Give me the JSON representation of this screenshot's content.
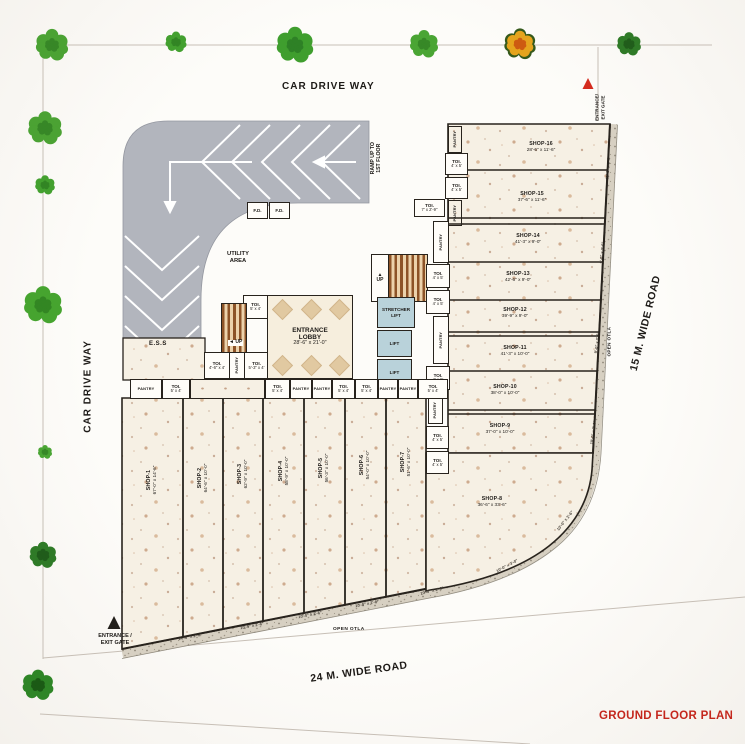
{
  "plan": {
    "title": "GROUND FLOOR PLAN",
    "roads": {
      "top": "CAR DRIVE WAY",
      "left": "CAR DRIVE WAY",
      "right": "15 M. WIDE ROAD",
      "bottom": "24 M. WIDE ROAD"
    },
    "gates": {
      "top_right_line1": "ENTRANCE/",
      "top_right_line2": "EXIT GATE",
      "bottom_left_line1": "ENTRANCE /",
      "bottom_left_line2": "EXIT GATE"
    },
    "ramp": {
      "line1": "RAMP UP TO",
      "line2": "1ST FLOOR",
      "ess": "E.S.S"
    },
    "utility": {
      "line1": "UTILITY",
      "line2": "AREA"
    },
    "lobby": {
      "line1": "ENTRANCE",
      "line2": "LOBBY",
      "dims": "28'-6\" x 21'-0\""
    },
    "stairs": {
      "up": "UP",
      "arrow_up": "▲",
      "arrow_left": "◄"
    },
    "lifts": {
      "stretcher_line1": "STRETCHER",
      "stretcher_line2": "LIFT",
      "lift": "LIFT"
    },
    "fd": "F.D.",
    "open_otla": "OPEN OTLA",
    "pantry": "PANTRY",
    "toilets": {
      "t5x4": {
        "name": "TOI.",
        "dims": "5' x 4'"
      },
      "t4x5": {
        "name": "TOI.",
        "dims": "4' x 5'"
      },
      "t46x4": {
        "name": "TOI.",
        "dims": "4'-6\" x 4'"
      },
      "t53x4": {
        "name": "TOI.",
        "dims": "5'-3\" x 4'"
      },
      "t7x29": {
        "name": "TOI.",
        "dims": "7' x 2'-9\""
      }
    },
    "shops_left": [
      {
        "name": "SHOP-1",
        "dims": "67'-0\" x 14'-6\""
      },
      {
        "name": "SHOP-2",
        "dims": "64'-6\" x 10'-0\""
      },
      {
        "name": "SHOP-3",
        "dims": "62'-9\" x 10'-0\""
      },
      {
        "name": "SHOP-4",
        "dims": "58'-9\" x 10'-0\""
      },
      {
        "name": "SHOP-5",
        "dims": "56'-3\" x 10'-0\""
      },
      {
        "name": "SHOP-6",
        "dims": "54'-0\" x 10'-0\""
      },
      {
        "name": "SHOP-7",
        "dims": "51'-6\" x 10'-0\""
      }
    ],
    "shop8": {
      "name": "SHOP-8",
      "dims": "36'-6\" x 33'-6\""
    },
    "shops_right": [
      {
        "name": "SHOP-16",
        "dims": "28'-6\" x 11'-6\""
      },
      {
        "name": "SHOP-15",
        "dims": "37'-6\" x 11'-6\""
      },
      {
        "name": "SHOP-14",
        "dims": "41'-3\" x 9'-0\""
      },
      {
        "name": "SHOP-13",
        "dims": "42'-6\" x 9'-0\""
      },
      {
        "name": "SHOP-12",
        "dims": "39'-9\" x 9'-0\""
      },
      {
        "name": "SHOP-11",
        "dims": "41'-3\" x 10'-0\""
      },
      {
        "name": "SHOP-10",
        "dims": "38'-0\" x 10'-0\""
      },
      {
        "name": "SHOP-9",
        "dims": "37'-0\" x 10'-0\""
      }
    ],
    "otla_dims": [
      "14'-6\" x 2'-6\"",
      "10'-0\" x 2'-6\"",
      "10'-0\" x 2'-6\"",
      "10'-0\" x 2'-6\"",
      "10'-0\" x 2'-6\"",
      "10'-0\" x 3'-0\"",
      "10'-0\" x 2'-6\"",
      "10'-0\" x 2'-6\"",
      "9'-0\" x 2'-6\"",
      "9'-0\" x 2'-6\"",
      "11'-6\" x 2'-6\""
    ],
    "colors": {
      "title_red": "#c4271d",
      "ramp_gray": "#b2b5bd",
      "lift_blue": "#b9d2da",
      "stair_brown": "#8d5327",
      "marble_cream": "#f6f0e4",
      "granite": "#d7d0c2",
      "tree_green": "#45a231",
      "tree_orange": "#e5a41d",
      "tree_dark_green": "#2f7a27"
    }
  }
}
